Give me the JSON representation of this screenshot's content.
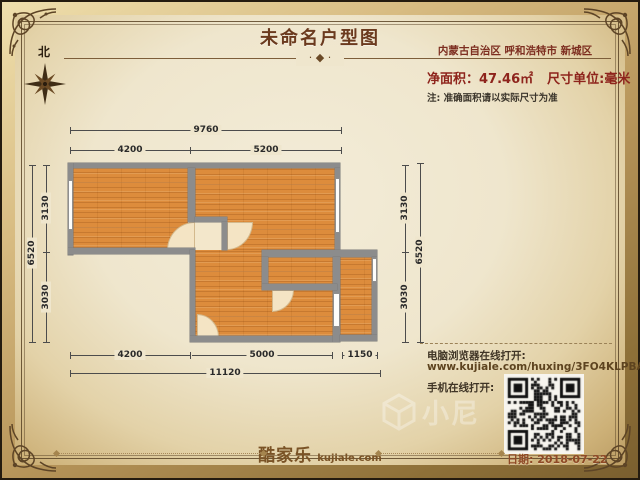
{
  "header": {
    "title": "未命名户型图",
    "location": "内蒙古自治区 呼和浩特市 新城区",
    "area_label": "净面积：47.46㎡",
    "unit_label": "尺寸单位:毫米",
    "note": "注: 准确面积请以实际尺寸为准",
    "north_label": "北"
  },
  "plan": {
    "top": {
      "overall": "9760",
      "segs": [
        "4200",
        "5200"
      ]
    },
    "bottom": {
      "overall": "11120",
      "segs": [
        "4200",
        "5000",
        "1150"
      ]
    },
    "left": {
      "overall": "6520",
      "segs": [
        "3130",
        "3030"
      ]
    },
    "right": {
      "overall": "6520",
      "segs": [
        "3130",
        "3030"
      ]
    }
  },
  "footer": {
    "pc_label": "电脑浏览器在线打开:",
    "url": "www.kujiale.com/huxing/3FO4KLPBAJPP",
    "mobile_label": "手机在线打开:",
    "logo_cn": "酷家乐",
    "logo_domain": "kujiale.com",
    "date": "日期: 2018-07-22",
    "watermark": "小尼"
  },
  "colors": {
    "accent_red": "#8e241c",
    "title_brown": "#6b3a1e",
    "wall_gray": "#8c8c8c",
    "floor_orange": "#dd8c3c",
    "frame_gold": "#c2a266"
  }
}
